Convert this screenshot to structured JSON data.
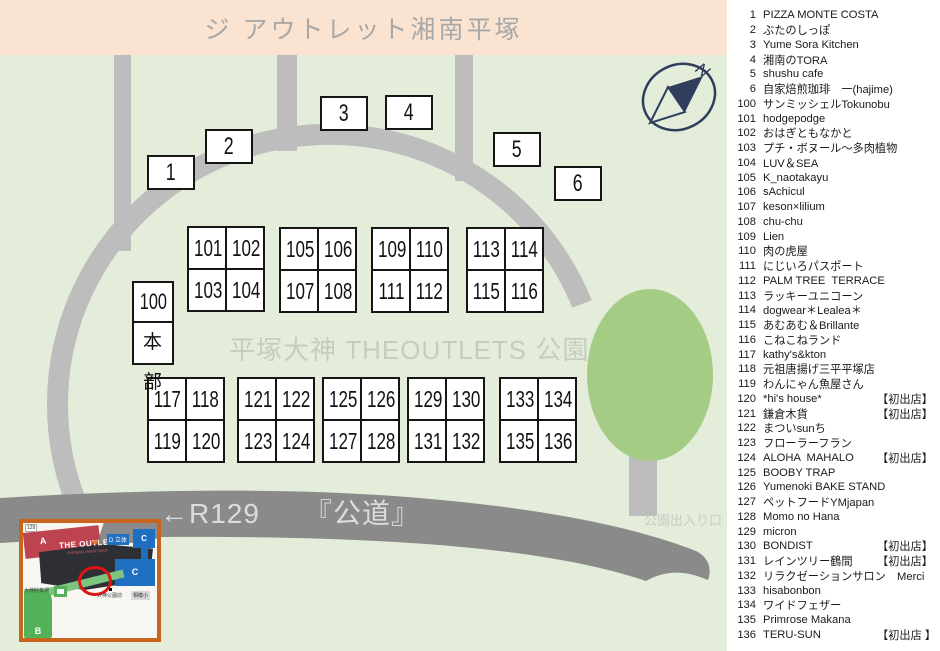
{
  "title_banner": "ジ アウトレット湘南平塚",
  "map": {
    "park_label": "平塚大神 THEOUTLETS 公園",
    "road_label": "←R129　　『公道』",
    "exit_label": "公園出入り口",
    "compass_n": "N",
    "hq": {
      "number": "100",
      "label": "本部"
    },
    "single_booths": [
      "1",
      "2",
      "3",
      "4",
      "5",
      "6"
    ],
    "booth_grids": [
      [
        "101",
        "102",
        "103",
        "104"
      ],
      [
        "105",
        "106",
        "107",
        "108"
      ],
      [
        "109",
        "110",
        "111",
        "112"
      ],
      [
        "113",
        "114",
        "115",
        "116"
      ],
      [
        "117",
        "118",
        "119",
        "120"
      ],
      [
        "121",
        "122",
        "123",
        "124"
      ],
      [
        "125",
        "126",
        "127",
        "128"
      ],
      [
        "129",
        "130",
        "131",
        "132"
      ],
      [
        "133",
        "134",
        "135",
        "136"
      ]
    ]
  },
  "inset": {
    "zone_a": "A",
    "zone_b": "B",
    "zone_c1": "C",
    "zone_c2": "C",
    "zone_d": "D 立体",
    "outlets_name": "THE OUTLETS",
    "outlets_sub": "SHONAN HIRATSUKA",
    "route_shield": "129",
    "label_parking": "大神駐車場",
    "label_park": "大神公園前",
    "label_school": "相模小"
  },
  "legend": {
    "rows": [
      {
        "num": "1",
        "name": "PIZZA MONTE COSTA"
      },
      {
        "num": "2",
        "name": "ぶたのしっぽ"
      },
      {
        "num": "3",
        "name": "Yume Sora Kitchen"
      },
      {
        "num": "4",
        "name": "湘南のTORA"
      },
      {
        "num": "5",
        "name": "shushu cafe"
      },
      {
        "num": "6",
        "name": "自家焙煎珈琲　一(hajime)"
      },
      {
        "num": "100",
        "name": "サンミッシェルTokunobu"
      },
      {
        "num": "101",
        "name": "hodgepodge"
      },
      {
        "num": "102",
        "name": "おはぎともなかと"
      },
      {
        "num": "103",
        "name": "プチ・ボヌール～多肉植物"
      },
      {
        "num": "104",
        "name": "LUV＆SEA"
      },
      {
        "num": "105",
        "name": "K_naotakayu"
      },
      {
        "num": "106",
        "name": "sAchicul"
      },
      {
        "num": "107",
        "name": "keson×lilium"
      },
      {
        "num": "108",
        "name": "chu-chu"
      },
      {
        "num": "109",
        "name": "Lien"
      },
      {
        "num": "110",
        "name": "肉の虎屋"
      },
      {
        "num": "111",
        "name": "にじいろパスポート"
      },
      {
        "num": "112",
        "name": "PALM TREE  TERRACE"
      },
      {
        "num": "113",
        "name": "ラッキーユニコーン"
      },
      {
        "num": "114",
        "name": "dogwear＊Lealea＊"
      },
      {
        "num": "115",
        "name": "あむあむ＆Brillante"
      },
      {
        "num": "116",
        "name": "こねこねランド"
      },
      {
        "num": "117",
        "name": "kathy's&kton"
      },
      {
        "num": "118",
        "name": "元祖唐揚げ三平平塚店"
      },
      {
        "num": "119",
        "name": "わんにゃん魚屋さん"
      },
      {
        "num": "120",
        "name": "*hi's house*",
        "badge": "【初出店】"
      },
      {
        "num": "121",
        "name": "鎌倉木貨",
        "badge": "【初出店】"
      },
      {
        "num": "122",
        "name": "まついsunち"
      },
      {
        "num": "123",
        "name": "フローラーフラン"
      },
      {
        "num": "124",
        "name": "ALOHA  MAHALO",
        "badge": "【初出店】"
      },
      {
        "num": "125",
        "name": "BOOBY TRAP"
      },
      {
        "num": "126",
        "name": "Yumenoki BAKE STAND"
      },
      {
        "num": "127",
        "name": "ペットフードYMjapan"
      },
      {
        "num": "128",
        "name": "Momo no Hana"
      },
      {
        "num": "129",
        "name": "micron"
      },
      {
        "num": "130",
        "name": "BONDIST",
        "badge": "【初出店】"
      },
      {
        "num": "131",
        "name": "レインツリー鶴間",
        "badge": "【初出店】"
      },
      {
        "num": "132",
        "name": "リラクゼーションサロン　Merci"
      },
      {
        "num": "133",
        "name": "hisabonbon"
      },
      {
        "num": "134",
        "name": "ワイドフェザー"
      },
      {
        "num": "135",
        "name": "Primrose Makana"
      },
      {
        "num": "136",
        "name": "TERU-SUN",
        "badge": "【初出店 】"
      }
    ]
  },
  "colors": {
    "banner_bg": "#FAE3D1",
    "map_bg": "#E3EDDA",
    "road_light": "#BDBDBD",
    "road_dark": "#8A8A8A",
    "park_green": "#A4CC85",
    "compass_navy": "#2F3E5C",
    "inset_border_orange": "#C8641E",
    "inset_blue": "#1F6FC0",
    "inset_red": "#BE4350",
    "inset_green": "#53B257",
    "annotation_red": "#E11414"
  }
}
